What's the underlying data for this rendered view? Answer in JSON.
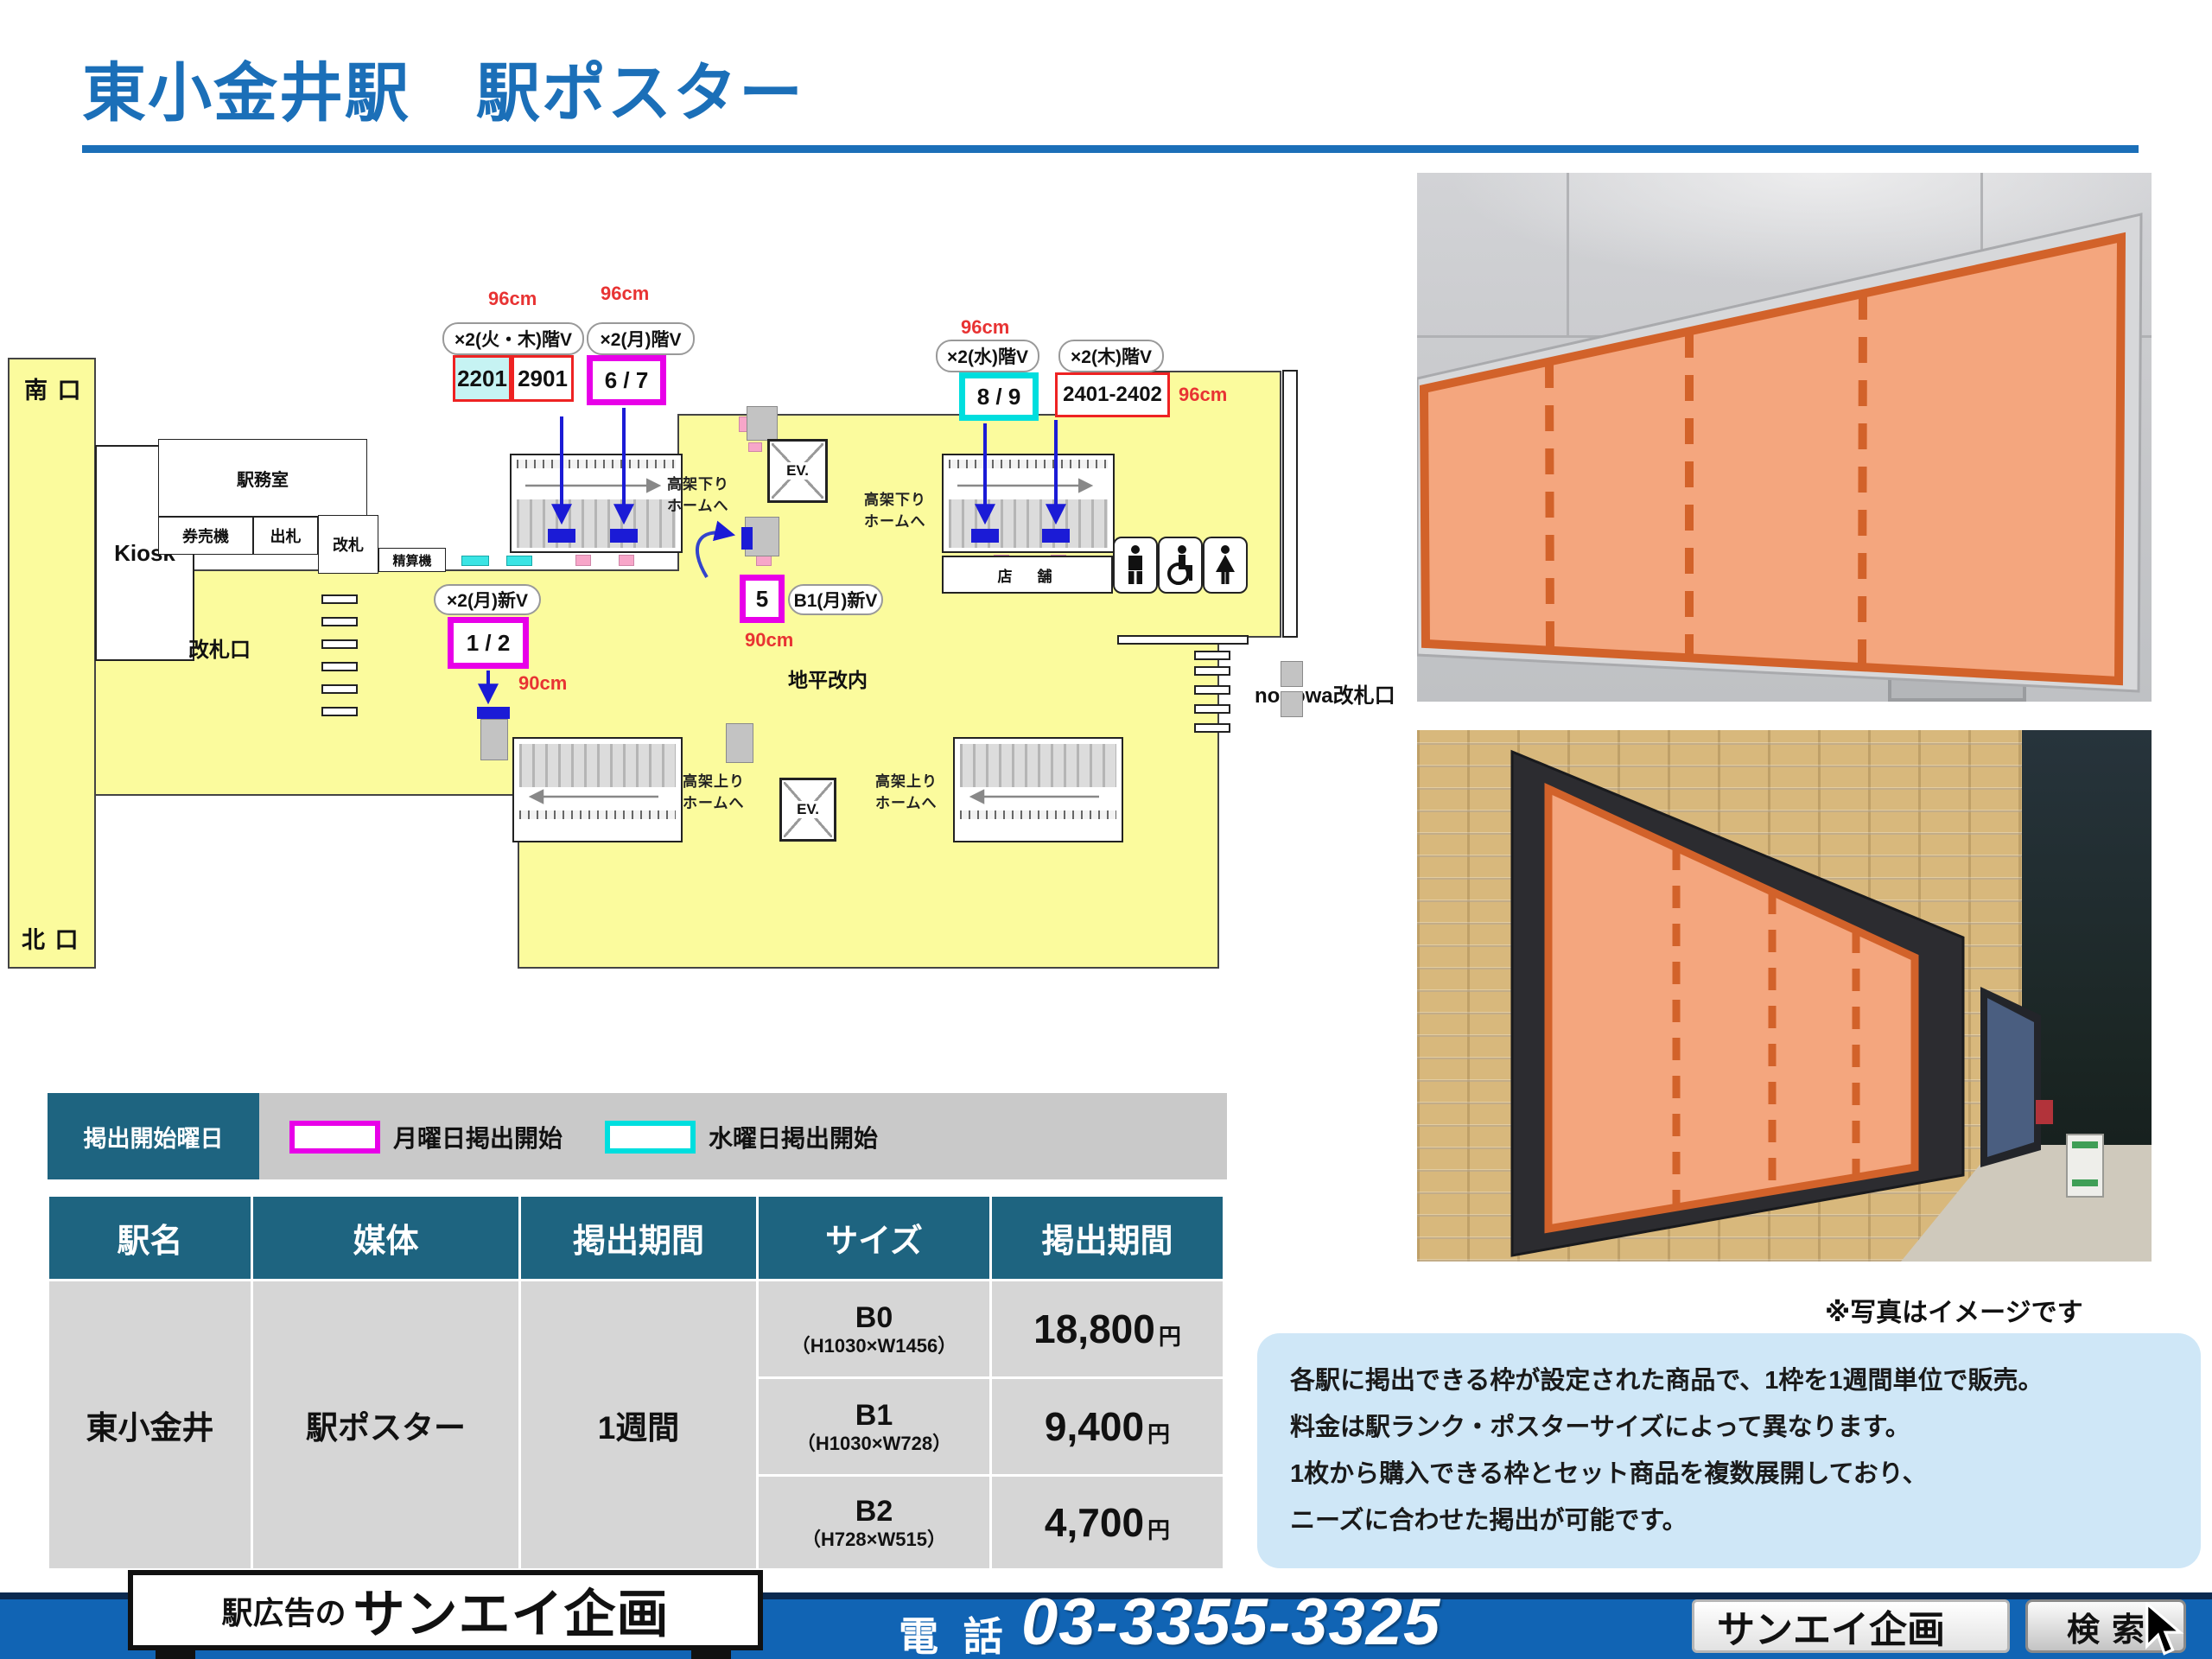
{
  "title": "東小金井駅　駅ポスター",
  "photo_note": "※写真はイメージです",
  "colors": {
    "title_blue": "#1b6fb8",
    "table_header_teal": "#1e6480",
    "map_yellow": "#fbfb9d",
    "monday_magenta": "#e800e8",
    "wednesday_cyan": "#00dede",
    "dimension_red": "#e83333",
    "highlight_orange_fill": "#f4a67e",
    "highlight_orange_border": "#d2622a",
    "footer_blue": "#1164b4"
  },
  "map": {
    "south_exit": "南 口",
    "north_exit": "北 口",
    "kiosk": "Kiosk",
    "office": "駅務室",
    "ticket_machines": "券売機",
    "exit_counter": "出札",
    "gate": "改札",
    "fare_adjust": "精算機",
    "gate_area": "改札口",
    "shops": "店　舗",
    "ground": "地平改内",
    "nonowa": "nonowa改札口",
    "ev": "EV.",
    "down1": "高架下り",
    "down2": "ホームへ",
    "up1": "高架上り",
    "up2": "ホームへ",
    "size96": "96cm",
    "size90": "90cm",
    "tags": {
      "kaboku": "×2(火・木)階V",
      "getsu_kai": "×2(月)階V",
      "sui": "×2(水)階V",
      "moku": "×2(木)階V",
      "getsu_shin": "×2(月)新V",
      "b1_shin": "B1(月)新V"
    },
    "slots": {
      "s2201": "2201",
      "s2901": "2901",
      "s67": "6 / 7",
      "s89": "8 / 9",
      "s2401": "2401-2402",
      "s12": "1 / 2",
      "s5": "5"
    },
    "icons": {
      "mens": "mens-room-icon",
      "accessible": "wheelchair-icon",
      "womens": "womens-room-icon"
    }
  },
  "legend": {
    "title": "掲出開始曜日",
    "monday": "月曜日掲出開始",
    "wednesday": "水曜日掲出開始"
  },
  "table": {
    "headers": [
      "駅名",
      "媒体",
      "掲出期間",
      "サイズ",
      "掲出期間"
    ],
    "station": "東小金井",
    "media": "駅ポスター",
    "period": "1週間",
    "rows": [
      {
        "size": "B0",
        "dims": "（H1030×W1456）",
        "price": "18,800",
        "unit": "円"
      },
      {
        "size": "B1",
        "dims": "（H1030×W728）",
        "price": "9,400",
        "unit": "円"
      },
      {
        "size": "B2",
        "dims": "（H728×W515）",
        "price": "4,700",
        "unit": "円"
      }
    ]
  },
  "info": {
    "lines": [
      "各駅に掲出できる枠が設定された商品で、1枠を1週間単位で販売。",
      "料金は駅ランク・ポスターサイズによって異なります。",
      "1枚から購入できる枠とセット商品を複数展開しており、",
      "ニーズに合わせた掲出が可能です。"
    ]
  },
  "footer": {
    "sign_prefix": "駅広告の",
    "sign_name": "サンエイ企画",
    "tel_label": "電 話",
    "tel_number": "03-3355-3325",
    "search_value": "サンエイ企画",
    "search_button": "検索",
    "cursor": "mouse-cursor-icon"
  }
}
